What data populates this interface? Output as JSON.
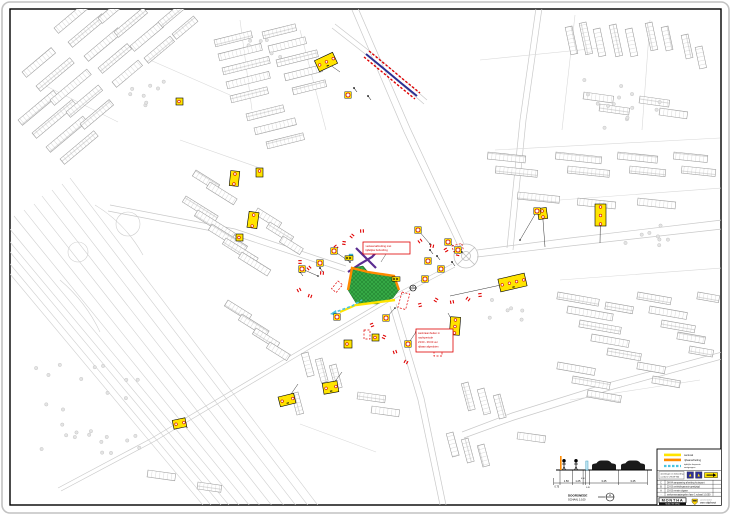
{
  "colors": {
    "work_zone_green": "#35a845",
    "zone_border_orange": "#ff8a00",
    "zone_border_yellow": "#ffe400",
    "route_cyan": "#49c3e0",
    "closure_purple": "#5b2d91",
    "detour_blue": "#2e3192",
    "marker_red": "#e00000",
    "sign_yellow": "#ffe400",
    "map_line_gray": "#c9c9c9"
  },
  "legend": {
    "items": [
      {
        "label": "werkvak",
        "color": "#ffe400",
        "style": "solid"
      },
      {
        "label": "rijbaanafzetting",
        "color": "#ff8a00",
        "style": "solid"
      },
      {
        "label": "tijdelijke looproute",
        "label2": "voetgangers",
        "color": "#49c3e0",
        "style": "dashed"
      }
    ],
    "note_lines": [
      "afzettingen en bebording",
      "conform CROW 96b"
    ]
  },
  "revisions": [
    {
      "no": "C",
      "text": "08-04  aanpassing afzetting kruispunt"
    },
    {
      "no": "B",
      "text": "22-03  omleidingsroute gewijzigd"
    },
    {
      "no": "A",
      "text": "15-03  eerste uitgave"
    },
    {
      "no": "-",
      "text": "verkeersmaatregelen fase 1   schaal 1:1000"
    }
  ],
  "title_block": {
    "contractor": "MONTHA",
    "contractor_tag": "MOBILITEIT  INFRA",
    "client_small": "aannemersbedrijf",
    "client": "van stiphout"
  },
  "section": {
    "title": "DOORSNEDE",
    "scale": "SCHAAL 1:100",
    "mark": "A",
    "left_dim": "0.75",
    "dims": [
      "1.50",
      "1.25",
      "0.30",
      "0.45",
      "3.45",
      "3.45"
    ]
  },
  "callouts": {
    "top": {
      "lines": [
        "verkeersafzetting met",
        "tijdelijke bebording"
      ]
    },
    "night": {
      "lines": [
        "werkzaamheden in",
        "nachtperiode",
        "23:00 - 06:00 uur",
        "rijbaan afgesloten"
      ]
    }
  },
  "map": {
    "boards": [
      {
        "x": 316,
        "y": 56,
        "w": 20,
        "h": 12,
        "r": -25,
        "g": 3,
        "lead": [
          340,
          72
        ]
      },
      {
        "x": 230,
        "y": 171,
        "w": 9,
        "h": 15,
        "r": 6,
        "g": 2
      },
      {
        "x": 256,
        "y": 168,
        "w": 7,
        "h": 9,
        "r": 0,
        "g": 1
      },
      {
        "x": 248,
        "y": 212,
        "w": 10,
        "h": 16,
        "r": 8,
        "g": 2
      },
      {
        "x": 236,
        "y": 234,
        "w": 7,
        "h": 7,
        "r": 0,
        "g": 1
      },
      {
        "x": 595,
        "y": 204,
        "w": 11,
        "h": 22,
        "r": 0,
        "g": 3,
        "lead": [
          600,
          243
        ]
      },
      {
        "x": 538,
        "y": 208,
        "w": 9,
        "h": 11,
        "r": -8,
        "g": 2,
        "lead": [
          545,
          247
        ]
      },
      {
        "x": 499,
        "y": 276,
        "w": 27,
        "h": 13,
        "r": -13,
        "g": 4,
        "lead": [
          450,
          296
        ]
      },
      {
        "x": 450,
        "y": 317,
        "w": 10,
        "h": 18,
        "r": 4,
        "g": 3,
        "lead": [
          448,
          313
        ]
      },
      {
        "x": 323,
        "y": 382,
        "w": 15,
        "h": 11,
        "r": -10,
        "g": 2,
        "lead": [
          342,
          372
        ]
      },
      {
        "x": 279,
        "y": 395,
        "w": 16,
        "h": 10,
        "r": -14,
        "g": 2,
        "lead": [
          298,
          384
        ]
      },
      {
        "x": 173,
        "y": 419,
        "w": 13,
        "h": 9,
        "r": -12,
        "g": 2,
        "lead": [
          188,
          428
        ]
      },
      {
        "x": 344,
        "y": 340,
        "w": 8,
        "h": 8,
        "r": 0,
        "g": 1
      },
      {
        "x": 372,
        "y": 334,
        "w": 7,
        "h": 7,
        "r": 0,
        "g": 1
      },
      {
        "x": 176,
        "y": 98,
        "w": 7,
        "h": 7,
        "r": 0,
        "g": 1
      }
    ],
    "roundels": [
      {
        "p": [
          320,
          263
        ]
      },
      {
        "p": [
          334,
          251
        ],
        "lead": [
          350,
          262
        ]
      },
      {
        "p": [
          428,
          261
        ]
      },
      {
        "p": [
          441,
          269
        ]
      },
      {
        "p": [
          425,
          279
        ]
      },
      {
        "p": [
          448,
          242
        ],
        "lead": [
          462,
          252
        ]
      },
      {
        "p": [
          458,
          250
        ]
      },
      {
        "p": [
          537,
          211
        ],
        "lead": [
          520,
          240
        ]
      },
      {
        "p": [
          348,
          95
        ]
      },
      {
        "p": [
          386,
          318
        ],
        "lead": [
          395,
          308
        ]
      },
      {
        "p": [
          408,
          344
        ],
        "lead": [
          416,
          332
        ]
      },
      {
        "p": [
          337,
          317
        ]
      },
      {
        "p": [
          302,
          269
        ],
        "lead": [
          318,
          276
        ]
      },
      {
        "p": [
          418,
          230
        ],
        "lead": [
          430,
          244
        ]
      }
    ],
    "arrowboards": [
      [
        349,
        258
      ],
      [
        396,
        279
      ]
    ],
    "red_ticks": [
      [
        300,
        262
      ],
      [
        309,
        268
      ],
      [
        322,
        273
      ],
      [
        336,
        247
      ],
      [
        344,
        243
      ],
      [
        420,
        241
      ],
      [
        432,
        246
      ],
      [
        446,
        250
      ],
      [
        458,
        254
      ],
      [
        299,
        290
      ],
      [
        310,
        296
      ],
      [
        372,
        325
      ],
      [
        384,
        337
      ],
      [
        395,
        352
      ],
      [
        406,
        362
      ],
      [
        420,
        305
      ],
      [
        436,
        300
      ],
      [
        452,
        302
      ],
      [
        468,
        299
      ],
      [
        480,
        295
      ],
      [
        352,
        236
      ],
      [
        362,
        231
      ]
    ],
    "red_zones": [
      [
        402,
        292,
        8,
        16,
        15
      ],
      [
        434,
        336,
        8,
        20,
        0
      ],
      [
        338,
        281,
        6,
        10,
        40
      ],
      [
        364,
        330,
        6,
        9,
        0
      ],
      [
        452,
        246,
        10,
        6,
        -15
      ]
    ],
    "posts": [
      [
        430,
        250
      ],
      [
        437,
        256
      ],
      [
        452,
        262
      ],
      [
        320,
        268
      ],
      [
        300,
        272
      ],
      [
        354,
        88
      ],
      [
        368,
        96
      ]
    ]
  }
}
